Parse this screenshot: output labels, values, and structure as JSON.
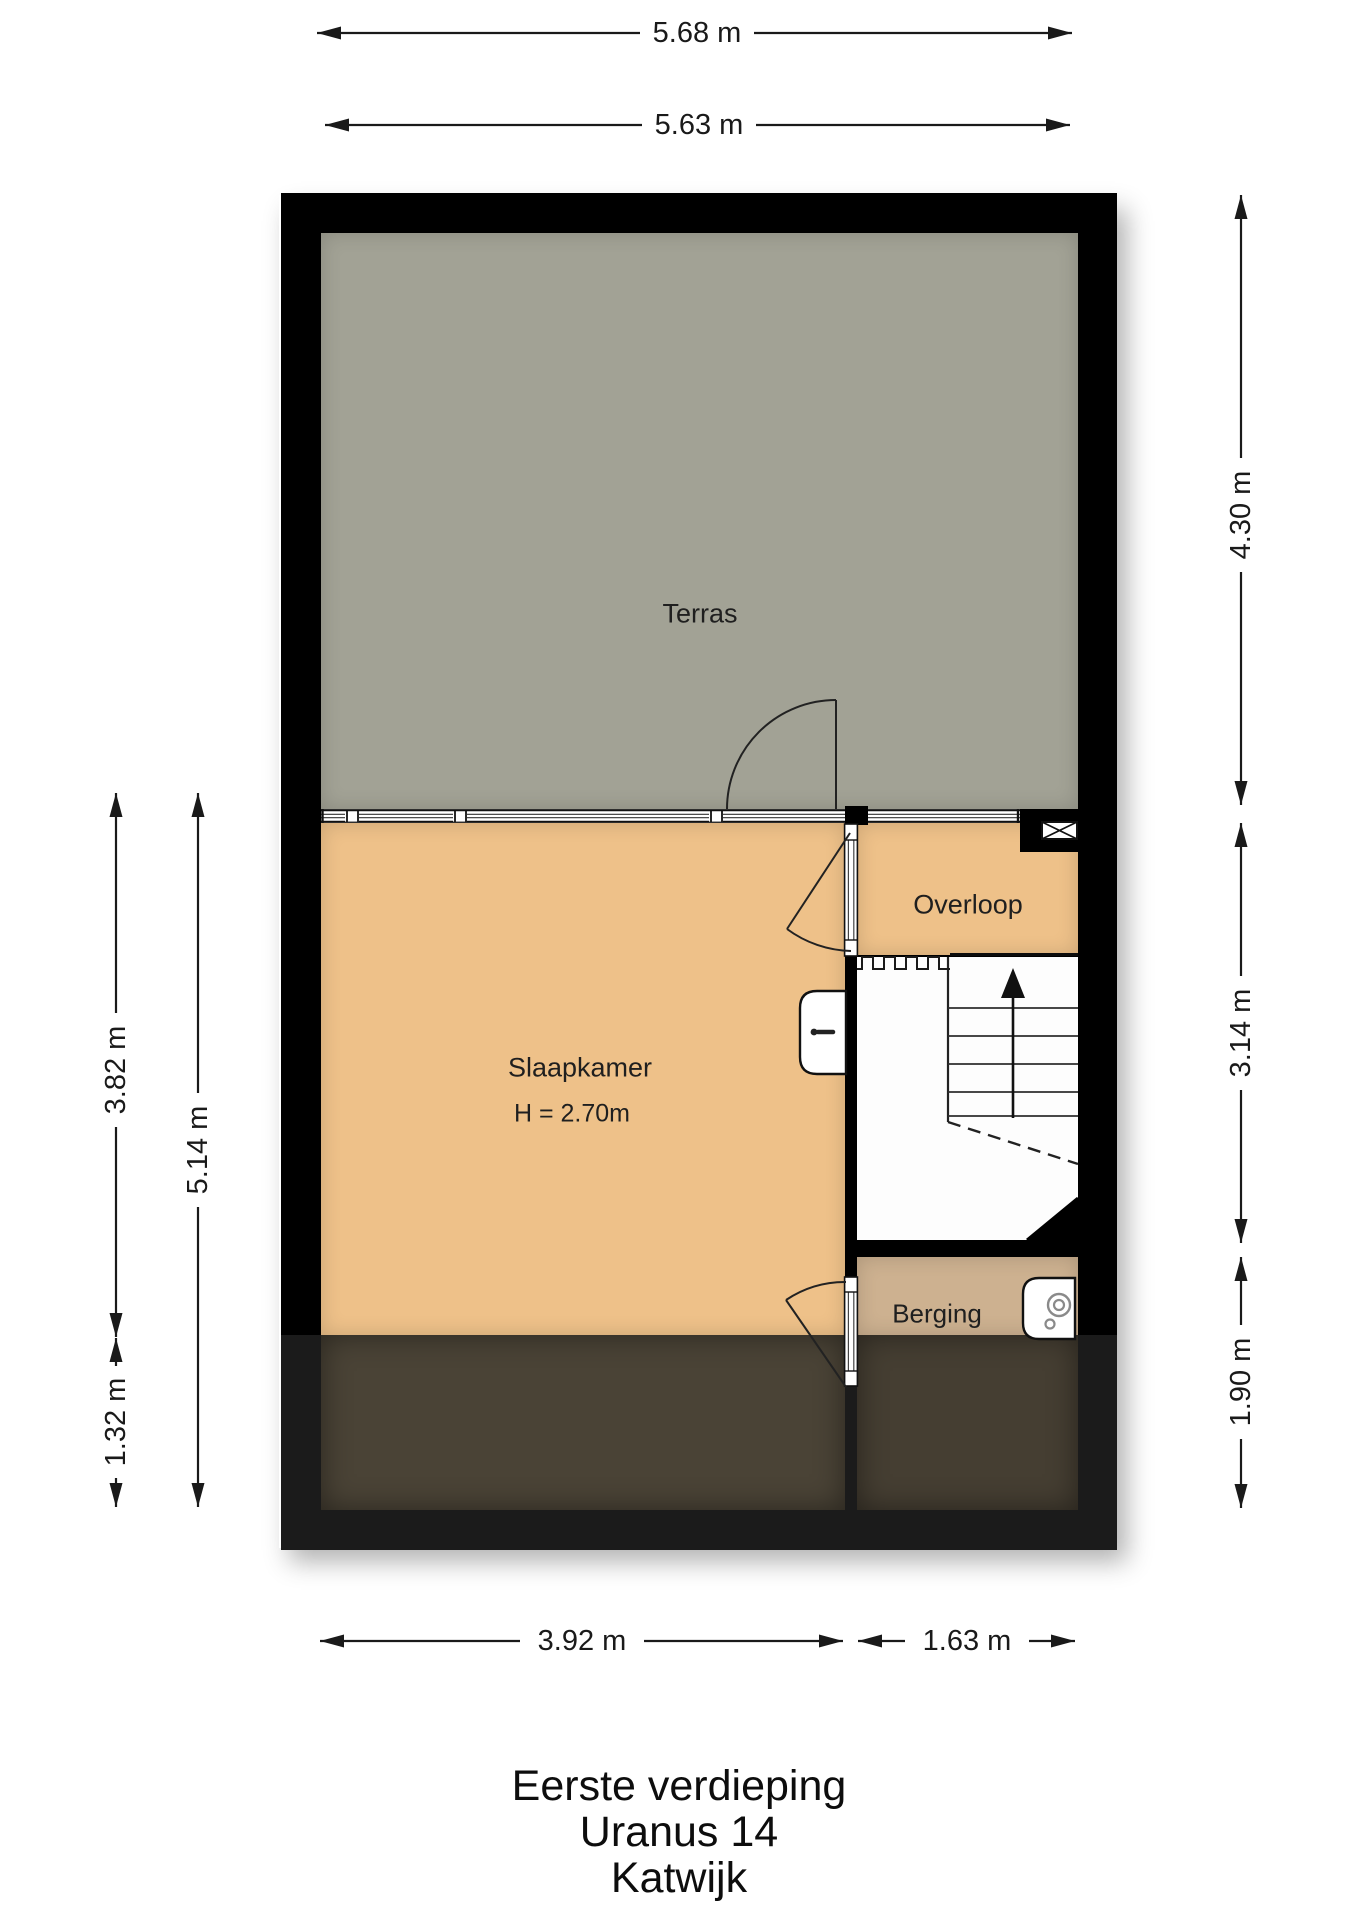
{
  "title": {
    "lines": [
      "Eerste verdieping",
      "Uranus 14",
      "Katwijk"
    ]
  },
  "rooms": {
    "terras": {
      "label": "Terras"
    },
    "slaapkamer": {
      "label": "Slaapkamer",
      "ceiling_height": "H = 2.70m"
    },
    "overloop": {
      "label": "Overloop"
    },
    "berging": {
      "label": "Berging"
    }
  },
  "dimensions": {
    "top_outer": "5.68 m",
    "top_inner": "5.63 m",
    "right_upper": "4.30 m",
    "right_middle": "3.14 m",
    "right_lower": "1.90 m",
    "left_upper": "3.82 m",
    "left_full": "5.14 m",
    "left_lower": "1.32 m",
    "bottom_left": "3.92 m",
    "bottom_right": "1.63 m"
  },
  "icons": {
    "stairs_arrow": "up-direction-arrow",
    "flue": "flue-x-symbol",
    "boiler": "boiler-unit",
    "sink": "wall-sink",
    "tear_line": "floor-opening-zigzag"
  },
  "colors": {
    "wall": "#000000",
    "wall_dark_zone": "#1b1b1b",
    "terras": "#a2a295",
    "room_orange": "#eec189",
    "berging": "#cdb190",
    "dark_overlay_bedroom": "#4a4336",
    "dark_overlay_berging": "#453e32",
    "dimension_text": "#1a1a1a"
  }
}
